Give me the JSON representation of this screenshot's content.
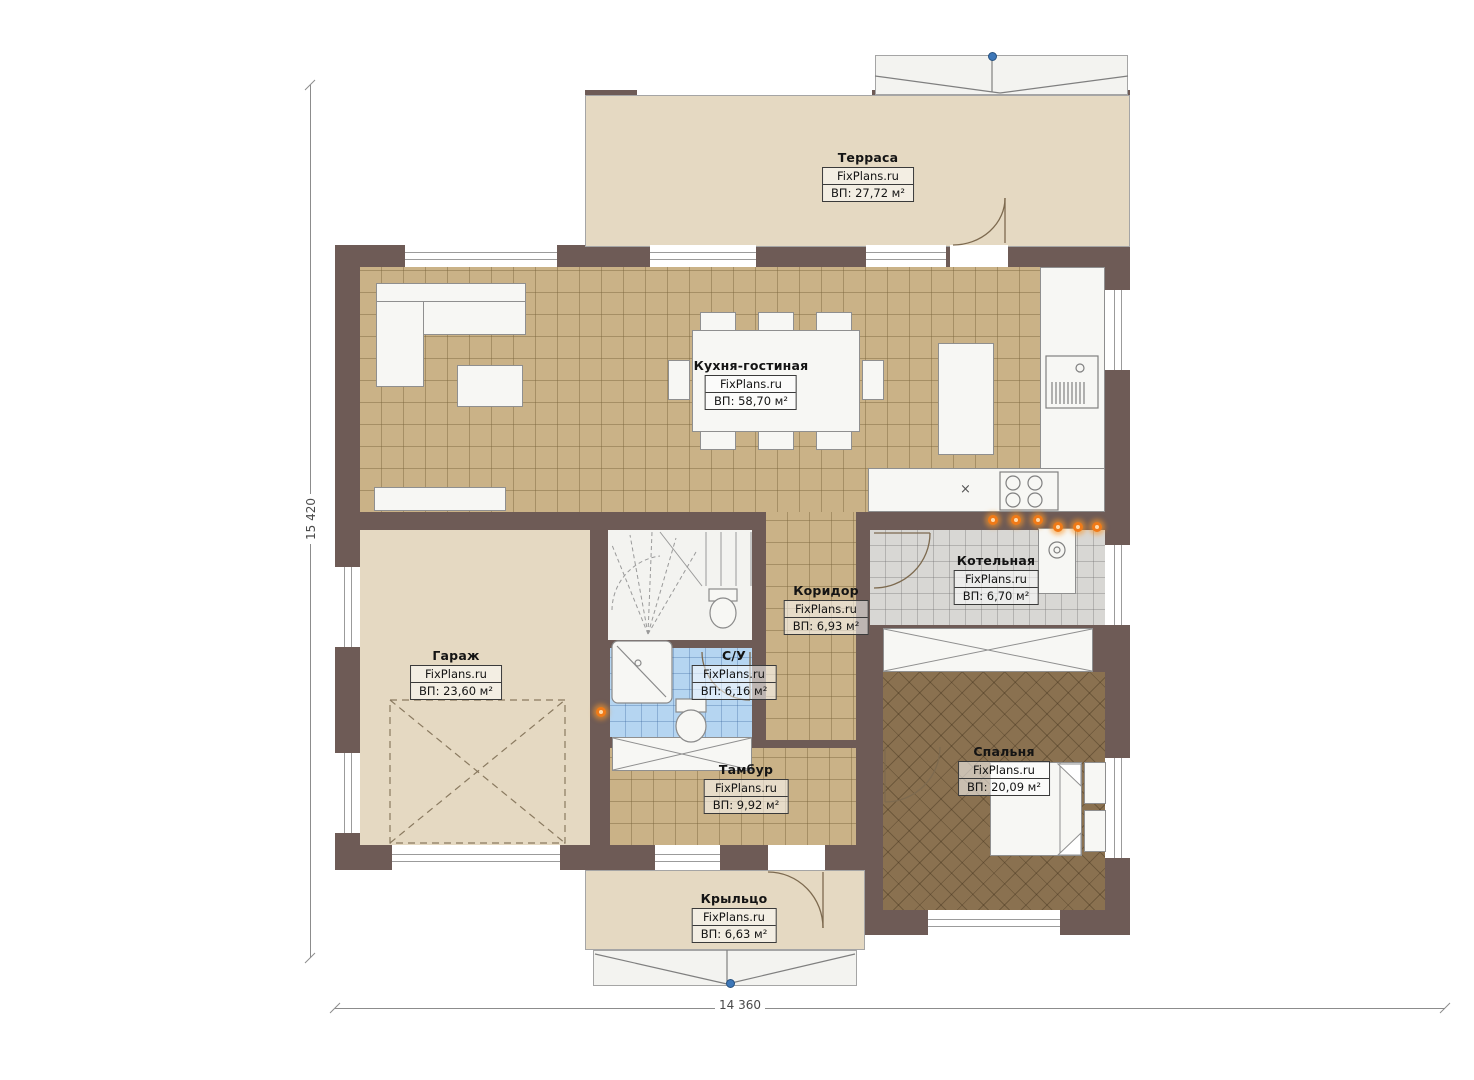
{
  "plan": {
    "brand": "FixPlans.ru",
    "dimensions": {
      "height_label": "15 420",
      "width_label": "14 360"
    },
    "palette": {
      "wall": "#6e5b56",
      "tile_tan": "#cab287",
      "tile_gray": "#d8d7d4",
      "tile_blue": "#b5d5f1",
      "tile_brown": "#8a7150",
      "plain_beige": "#e5d9c2",
      "accent_orange": "#f07a18",
      "accent_blue": "#3d77b8"
    },
    "kitchen": {
      "sink_symbol": "×"
    }
  },
  "rooms": [
    {
      "name": "Терраса",
      "brand": "FixPlans.ru",
      "area": "ВП: 27,72 м²"
    },
    {
      "name": "Кухня-гостиная",
      "brand": "FixPlans.ru",
      "area": "ВП: 58,70 м²"
    },
    {
      "name": "Гараж",
      "brand": "FixPlans.ru",
      "area": "ВП: 23,60 м²"
    },
    {
      "name": "Коридор",
      "brand": "FixPlans.ru",
      "area": "ВП: 6,93 м²"
    },
    {
      "name": "Котельная",
      "brand": "FixPlans.ru",
      "area": "ВП: 6,70 м²"
    },
    {
      "name": "С/У",
      "brand": "FixPlans.ru",
      "area": "ВП: 6,16 м²"
    },
    {
      "name": "Тамбур",
      "brand": "FixPlans.ru",
      "area": "ВП: 9,92 м²"
    },
    {
      "name": "Спальня",
      "brand": "FixPlans.ru",
      "area": "ВП: 20,09 м²"
    },
    {
      "name": "Крыльцо",
      "brand": "FixPlans.ru",
      "area": "ВП: 6,63 м²"
    }
  ]
}
